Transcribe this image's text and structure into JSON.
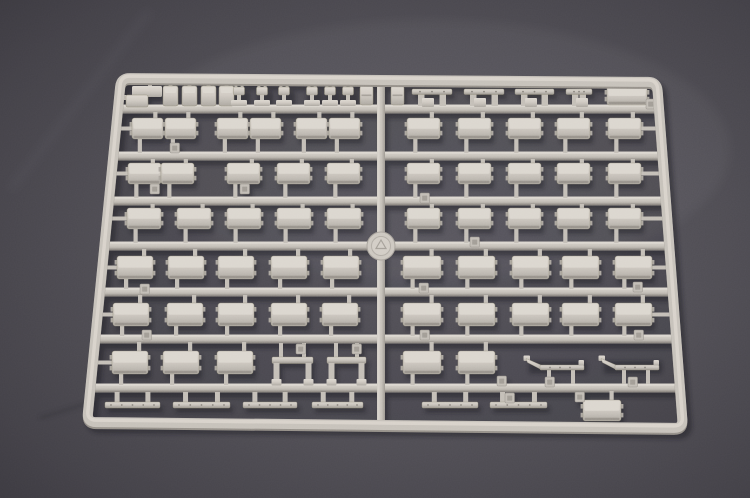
{
  "scene": {
    "description": "photograph of a light grey injection-molded model kit sprue on dark grey felt fabric",
    "background": {
      "center": "#5c5a61",
      "mid": "#4e4c52",
      "outer": "#434147",
      "edge": "#3c3a40",
      "noise_opacity": 0.5
    },
    "plastic": {
      "highlight": "#dcd7cf",
      "light": "#d3cec6",
      "topface": "#dbd6ce",
      "mid": "#c3beb6",
      "body": "#c6c1b9",
      "shade": "#aba69e",
      "dark": "#968f85",
      "outline": "#97927f",
      "inset": "#a19c94",
      "shadow": "#17161d"
    }
  },
  "sprue": {
    "frame": {
      "corners": {
        "tl": [
          121,
          78
        ],
        "tr": [
          657,
          82
        ],
        "br": [
          683,
          428
        ],
        "bl": [
          87,
          422
        ]
      },
      "thickness": 10,
      "corner_radius": 9
    },
    "rails_y": [
      109,
      156,
      201,
      246,
      292,
      339,
      388
    ],
    "center_rail": {
      "x": 377,
      "w": 8,
      "top": 84,
      "bottom": 422
    },
    "disc": {
      "cx": 381,
      "cy": 246,
      "r": 14
    },
    "box_rows": [
      {
        "y": 118,
        "h": 21,
        "rail": 109,
        "rail_below": 156,
        "arm_right": true,
        "boxes": [
          [
            132,
            31
          ],
          [
            165,
            31
          ],
          [
            217,
            31
          ],
          [
            250,
            31
          ],
          [
            296,
            31
          ],
          [
            329,
            31
          ],
          [
            407,
            33
          ],
          [
            458,
            33
          ],
          [
            508,
            33
          ],
          [
            557,
            33
          ],
          [
            608,
            33
          ]
        ]
      },
      {
        "y": 163,
        "h": 21,
        "rail": 156,
        "rail_below": 201,
        "arm_right": true,
        "boxes": [
          [
            128,
            33
          ],
          [
            161,
            33
          ],
          [
            227,
            33
          ],
          [
            277,
            33
          ],
          [
            327,
            33
          ],
          [
            407,
            33
          ],
          [
            458,
            33
          ],
          [
            508,
            33
          ],
          [
            557,
            33
          ],
          [
            608,
            33
          ]
        ]
      },
      {
        "y": 208,
        "h": 21,
        "rail": 201,
        "rail_below": 246,
        "arm_right": true,
        "boxes": [
          [
            127,
            34
          ],
          [
            177,
            34
          ],
          [
            227,
            34
          ],
          [
            277,
            34
          ],
          [
            327,
            34
          ],
          [
            407,
            33
          ],
          [
            458,
            33
          ],
          [
            508,
            33
          ],
          [
            557,
            33
          ],
          [
            608,
            33
          ]
        ]
      },
      {
        "y": 256,
        "h": 23,
        "rail": 246,
        "rail_below": 292,
        "arm_right": true,
        "boxes": [
          [
            117,
            36
          ],
          [
            168,
            36
          ],
          [
            218,
            36
          ],
          [
            271,
            36
          ],
          [
            323,
            36
          ],
          [
            403,
            38
          ],
          [
            458,
            37
          ],
          [
            512,
            37
          ],
          [
            562,
            37
          ],
          [
            615,
            37
          ]
        ]
      },
      {
        "y": 303,
        "h": 23,
        "rail": 292,
        "rail_below": 339,
        "arm_right": true,
        "boxes": [
          [
            113,
            36
          ],
          [
            167,
            36
          ],
          [
            218,
            36
          ],
          [
            271,
            36
          ],
          [
            322,
            36
          ],
          [
            403,
            38
          ],
          [
            458,
            37
          ],
          [
            512,
            37
          ],
          [
            562,
            37
          ],
          [
            615,
            37
          ]
        ]
      },
      {
        "y": 351,
        "h": 23,
        "rail": 339,
        "rail_below": 388,
        "arm_right": false,
        "boxes": [
          [
            112,
            36
          ],
          [
            163,
            36
          ],
          [
            217,
            36
          ],
          [
            403,
            38
          ],
          [
            458,
            37
          ]
        ]
      }
    ],
    "special_boxes": [
      {
        "x": 607,
        "y": 86,
        "w": 40,
        "h": 19,
        "rail": 82,
        "rail_below": null
      },
      {
        "x": 583,
        "y": 400,
        "w": 38,
        "h": 21,
        "rail": 388,
        "rail_below": null
      }
    ],
    "tall_rects": {
      "y": 86,
      "w": 15,
      "h": 20,
      "xs": [
        163,
        182,
        201,
        219
      ]
    },
    "center_rects": {
      "y": 86,
      "w": 13,
      "h": 19,
      "xs": [
        360,
        391
      ]
    },
    "pins": {
      "xs": [
        239,
        262,
        284,
        312,
        330,
        348
      ],
      "head_y": 87,
      "base_y": 100
    },
    "l_block": {
      "a": [
        132,
        86,
        30,
        11
      ],
      "b": [
        126,
        95,
        22,
        12
      ],
      "arm_y": 95,
      "stub_x": 148
    },
    "top_strips": {
      "y": 89,
      "bar_h": 5.5,
      "items": [
        [
          412,
          40
        ],
        [
          464,
          40
        ],
        [
          515,
          39
        ],
        [
          566,
          26
        ]
      ]
    },
    "bottom_strips": {
      "y": 402,
      "bar_h": 6,
      "rail": 388,
      "items": [
        [
          105,
          55
        ],
        [
          173,
          57
        ],
        [
          243,
          54
        ],
        [
          312,
          51
        ],
        [
          422,
          56
        ],
        [
          490,
          57
        ]
      ]
    },
    "angle_strips": {
      "bar_y": 365,
      "rail_below": 388,
      "items": [
        [
          526,
          58
        ],
        [
          601,
          58
        ]
      ]
    },
    "trestles": {
      "bar_y": 357,
      "rail": 339,
      "rail_below": 388,
      "items": [
        [
          272,
          41
        ],
        [
          327,
          39
        ]
      ]
    },
    "tabs": [
      [
        150,
        184
      ],
      [
        240,
        184
      ],
      [
        170,
        143
      ],
      [
        420,
        193
      ],
      [
        470,
        237
      ],
      [
        140,
        284
      ],
      [
        419,
        283
      ],
      [
        633,
        282
      ],
      [
        142,
        330
      ],
      [
        420,
        330
      ],
      [
        634,
        330
      ],
      [
        296,
        344
      ],
      [
        352,
        344
      ],
      [
        545,
        377
      ],
      [
        628,
        377
      ],
      [
        497,
        376
      ],
      [
        646,
        99
      ],
      [
        575,
        392
      ],
      [
        505,
        393
      ]
    ]
  }
}
